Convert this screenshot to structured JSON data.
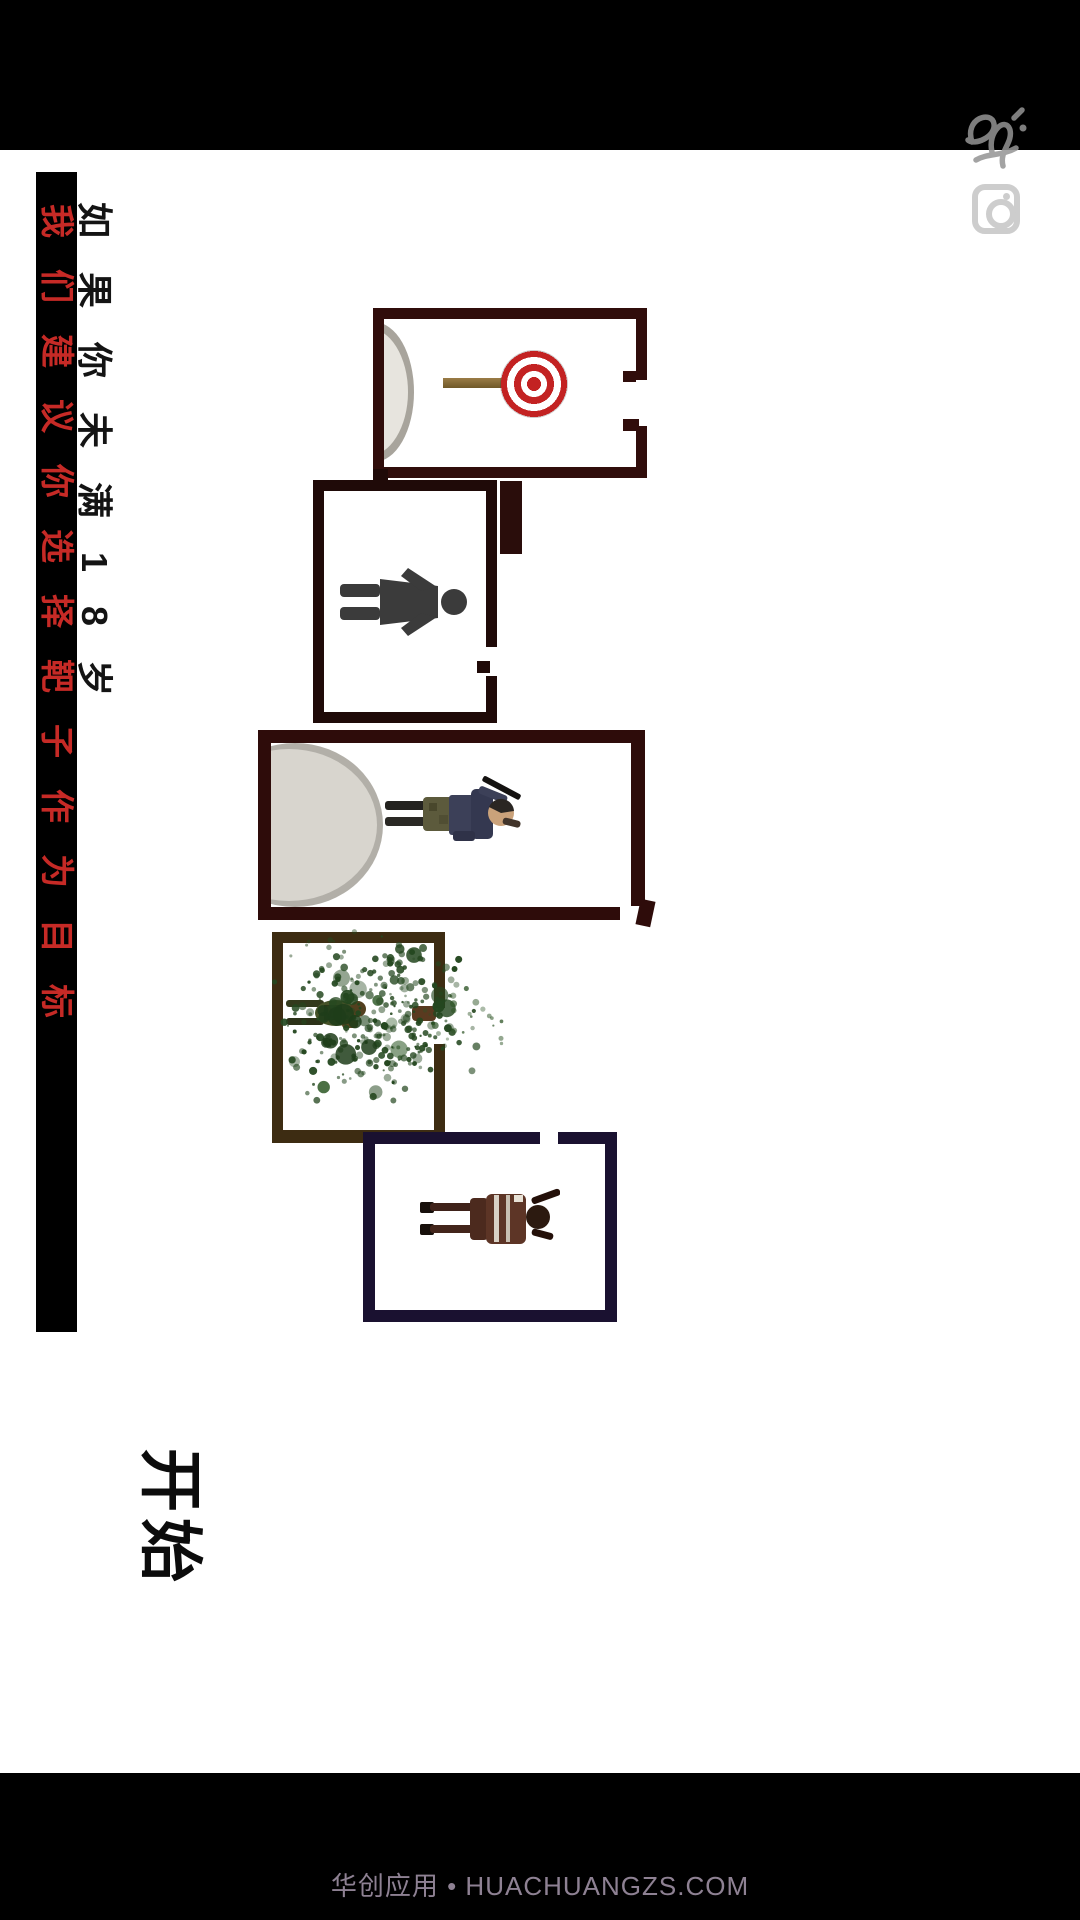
{
  "warning": {
    "line1": "如果你未满18岁",
    "line2": "我们建议你选择靶子作为目标",
    "line1_color": "#141414",
    "line2_color": "#c62a26",
    "bar_color": "#000000"
  },
  "start": {
    "label": "开始"
  },
  "footer": {
    "text": "华创应用 • HUACHUANGZS.COM",
    "color": "#8e8193"
  },
  "rooms": [
    {
      "name": "target-room",
      "content": "bullseye-target-on-post",
      "border_color": "#300d0b"
    },
    {
      "name": "silhouette-room",
      "content": "human-silhouette",
      "border_color": "#1f0a08"
    },
    {
      "name": "sniper-room",
      "content": "soldier-with-rifle",
      "border_color": "#2e0c0a"
    },
    {
      "name": "splatter-room",
      "content": "soldier-in-green-splatter",
      "border_color": "#3d2c12"
    },
    {
      "name": "soldier-room",
      "content": "standing-soldier",
      "border_color": "#1a1130"
    }
  ],
  "colors": {
    "status_bar": "#000000",
    "target_red": "#c32222",
    "splatter_green": "#2b4d24",
    "disc_gray": "#d8d5ce"
  }
}
